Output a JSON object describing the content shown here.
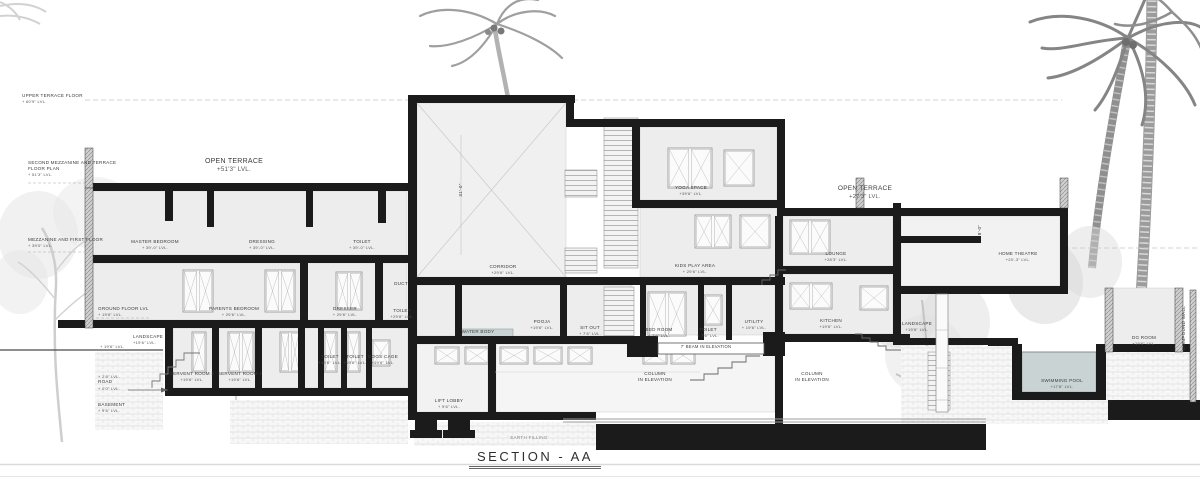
{
  "title": {
    "text": "SECTION - AA"
  },
  "drawing": {
    "type": "architectural building section",
    "sheet_name": "SECTION - AA"
  },
  "colors": {
    "wall": "#1b1b1b",
    "water": "#c9d3d3",
    "roomfill": "#ededed",
    "paper": "#ffffff"
  },
  "levels": [
    {
      "id": "upper-terrace-floor-level",
      "lines": [
        "UPPER TERRACE FLOOR",
        "+ 60'9\" LVL."
      ],
      "x": 22,
      "y": 93,
      "align": "l"
    },
    {
      "id": "second-mezzanine-terrace-level",
      "lines": [
        "SECOND MEZZANINE AND TERRACE",
        "FLOOR PLAN",
        "+ 51'3\" LVL."
      ],
      "x": 28,
      "y": 160,
      "align": "l"
    },
    {
      "id": "mezzanine-first-floor-level",
      "lines": [
        "MEZZANINE AND FIRST FLOOR",
        "+ 39'0\" LVL."
      ],
      "x": 28,
      "y": 237,
      "align": "l"
    },
    {
      "id": "ground-floor-level",
      "lines": [
        "GROUND FLOOR LVL",
        "+ 19'6\" LVL."
      ],
      "x": 98,
      "y": 306,
      "align": "l"
    },
    {
      "id": "landscape-level",
      "lines": [
        "LANDSCAPE",
        "+19'6\" LVL."
      ],
      "x": 133,
      "y": 334,
      "align": "l"
    },
    {
      "id": "plot-level",
      "lines": [
        "+ 19'6\" LVL."
      ],
      "x": 100,
      "y": 344,
      "align": "l"
    },
    {
      "id": "road-level",
      "lines": [
        "+ 2'6\" LVL.",
        "ROAD",
        "+ 0'0\" LVL."
      ],
      "x": 98,
      "y": 374,
      "align": "l"
    },
    {
      "id": "basement-level",
      "lines": [
        "BASEMENT",
        "+ 9'6\" LVL."
      ],
      "x": 98,
      "y": 402,
      "align": "l"
    }
  ],
  "rooms": [
    {
      "id": "open-terrace-left",
      "lines": [
        "OPEN TERRACE",
        "+51'3\" LVL."
      ],
      "x": 234,
      "y": 157,
      "fs": 7
    },
    {
      "id": "master-bedroom",
      "lines": [
        "MASTER BEDROOM",
        "+ 39'-0\" LVL."
      ],
      "x": 155,
      "y": 239
    },
    {
      "id": "dressing",
      "lines": [
        "DRESSING",
        "+ 39'-0\" LVL."
      ],
      "x": 262,
      "y": 239
    },
    {
      "id": "toilet-upper",
      "lines": [
        "TOILET",
        "+ 39'-0\" LVL."
      ],
      "x": 362,
      "y": 239
    },
    {
      "id": "parents-bedroom",
      "lines": [
        "PARENTS BEDROOM",
        "+ 29'6\" LVL."
      ],
      "x": 234,
      "y": 306
    },
    {
      "id": "dresser",
      "lines": [
        "DRESSER",
        "+ 29'6\" LVL."
      ],
      "x": 345,
      "y": 306
    },
    {
      "id": "duct",
      "lines": [
        "DUCT"
      ],
      "x": 401,
      "y": 281
    },
    {
      "id": "toilet-mid",
      "lines": [
        "TOILET",
        "+29'6\" LVL."
      ],
      "x": 402,
      "y": 308
    },
    {
      "id": "servant-room-2",
      "lines": [
        "SERVENT ROOM 2",
        "+19'6\" LVL."
      ],
      "x": 192,
      "y": 371
    },
    {
      "id": "servant-room-1",
      "lines": [
        "SERVENT ROOM 1",
        "+19'6\" LVL."
      ],
      "x": 240,
      "y": 371
    },
    {
      "id": "toilet-lower-1",
      "lines": [
        "TOILET",
        "+19'6\" LVL."
      ],
      "x": 330,
      "y": 354
    },
    {
      "id": "toilet-lower-2",
      "lines": [
        "TOILET",
        "+19'6\" LVL."
      ],
      "x": 355,
      "y": 354
    },
    {
      "id": "dogs-cage",
      "lines": [
        "DOGS CAGE",
        "+19'6\" LVL."
      ],
      "x": 383,
      "y": 354
    },
    {
      "id": "corridor",
      "lines": [
        "CORRIDOR",
        "+29'6\" LVL."
      ],
      "x": 503,
      "y": 264
    },
    {
      "id": "water-body",
      "lines": [
        "WATER BODY"
      ],
      "x": 478,
      "y": 329
    },
    {
      "id": "pooja",
      "lines": [
        "POOJA",
        "+19'6\" LVL."
      ],
      "x": 542,
      "y": 319
    },
    {
      "id": "sit-out",
      "lines": [
        "SIT OUT",
        "+ 7'6\" LVL."
      ],
      "x": 590,
      "y": 325
    },
    {
      "id": "bed-room-ground",
      "lines": [
        "BED ROOM",
        "+ 7'6\" LVL."
      ],
      "x": 659,
      "y": 327
    },
    {
      "id": "toilet-ground",
      "lines": [
        "TOILET",
        "+ 7'6\" LVL."
      ],
      "x": 708,
      "y": 327
    },
    {
      "id": "utility",
      "lines": [
        "UTILITY",
        "+ 19'6\" LVL."
      ],
      "x": 754,
      "y": 319
    },
    {
      "id": "kids-play-area",
      "lines": [
        "KIDS PLAY AREA",
        "+ 29'6\" LVL."
      ],
      "x": 695,
      "y": 263
    },
    {
      "id": "yoga-space",
      "lines": [
        "YOGA SPACE",
        "+39'6\" LVL."
      ],
      "x": 691,
      "y": 185
    },
    {
      "id": "lounge",
      "lines": [
        "LOUNGE",
        "+28'3\" LVL."
      ],
      "x": 836,
      "y": 251
    },
    {
      "id": "open-terrace-right",
      "lines": [
        "OPEN TERRACE",
        "+27'3\" LVL."
      ],
      "x": 865,
      "y": 185,
      "fs": 6.5
    },
    {
      "id": "home-theatre",
      "lines": [
        "HOME THEATRE",
        "+20'-3\" LVL."
      ],
      "x": 1018,
      "y": 251
    },
    {
      "id": "kitchen",
      "lines": [
        "KITCHEN",
        "+19'6\" LVL."
      ],
      "x": 831,
      "y": 318
    },
    {
      "id": "landscape-right",
      "lines": [
        "LANDSCAPE",
        "+19'6\" LVL."
      ],
      "x": 917,
      "y": 321
    },
    {
      "id": "lift-lobby",
      "lines": [
        "LIFT LOBBY",
        "+ 9'6\" LVL."
      ],
      "x": 449,
      "y": 398
    },
    {
      "id": "swimming-pool",
      "lines": [
        "SWIMMING POOL",
        "+17'6\" LVL."
      ],
      "x": 1062,
      "y": 378
    },
    {
      "id": "dg-room",
      "lines": [
        "DG ROOM",
        "+19'6\" LVL."
      ],
      "x": 1144,
      "y": 335
    }
  ],
  "annotations": [
    {
      "id": "column-in-elevation-1",
      "lines": [
        "COLUMN",
        "IN ELEVATION"
      ],
      "x": 655,
      "y": 371
    },
    {
      "id": "column-in-elevation-2",
      "lines": [
        "COLUMN",
        "IN ELEVATION"
      ],
      "x": 812,
      "y": 371
    },
    {
      "id": "beam-in-elevation",
      "lines": [
        "7' BEAM IN ELEVATION"
      ],
      "x": 706,
      "y": 344,
      "fs": 4.2
    },
    {
      "id": "earth-filling",
      "lines": [
        "EARTH FILLING"
      ],
      "x": 529,
      "y": 435,
      "color": "#8a8a8a"
    },
    {
      "id": "compound-wall",
      "lines": [
        "COMPOUND WALL"
      ],
      "x": 1184,
      "y": 328,
      "rot": -90
    },
    {
      "id": "dim-8ft",
      "lines": [
        "8'-0\""
      ],
      "x": 980,
      "y": 230,
      "rot": -90
    },
    {
      "id": "dim-31ft",
      "lines": [
        "31'-0\""
      ],
      "x": 461,
      "y": 190,
      "rot": -90
    }
  ]
}
